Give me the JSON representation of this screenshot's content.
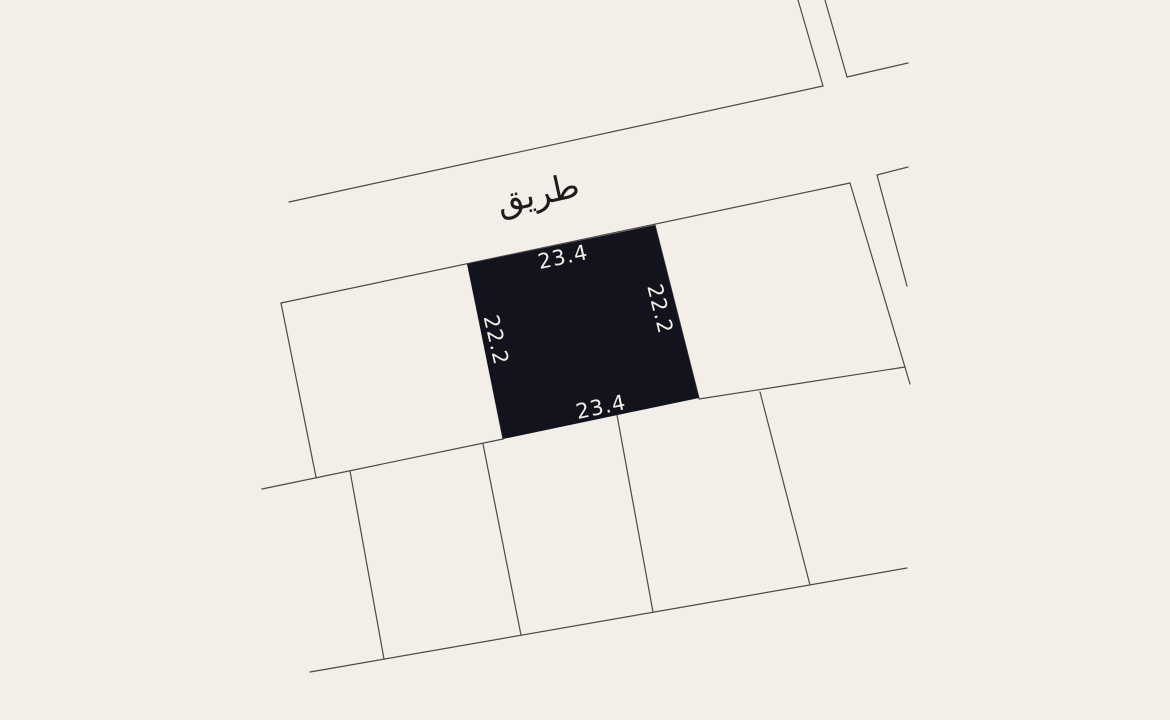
{
  "road": {
    "label": "طريق"
  },
  "plot": {
    "dimensions": {
      "top": "23.4",
      "right": "22.2",
      "bottom": "23.4",
      "left": "22.2"
    }
  },
  "colors": {
    "bg": "#f3eee8",
    "line": "#4a4a4a",
    "plot_fill": "#13131d",
    "dim_text": "#f3efe8",
    "road_text": "#1c1c1c"
  }
}
